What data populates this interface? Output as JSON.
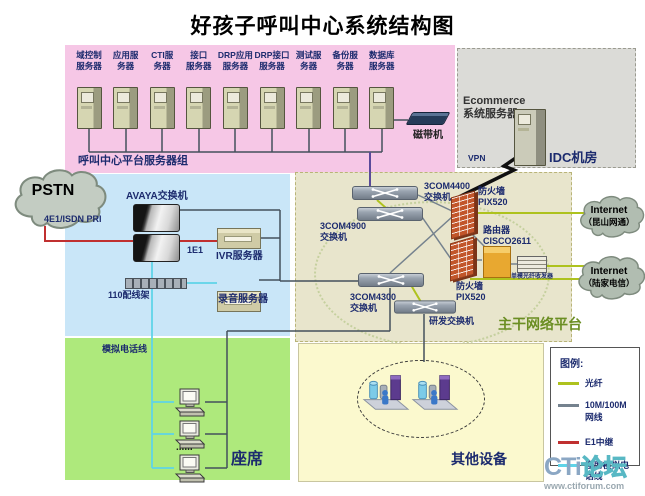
{
  "title": "好孩子呼叫中心系统结构图",
  "server_group": {
    "label": "呼叫中心平台服务器组",
    "servers": [
      {
        "line1": "域控制",
        "line2": "服务器"
      },
      {
        "line1": "应用服",
        "line2": "务器"
      },
      {
        "line1": "CTI服",
        "line2": "务器"
      },
      {
        "line1": "接口",
        "line2": "服务器"
      },
      {
        "line1": "DRP应用",
        "line2": "服务器"
      },
      {
        "line1": "DRP接口",
        "line2": "服务器"
      },
      {
        "line1": "测试服",
        "line2": "务器"
      },
      {
        "line1": "备份服",
        "line2": "务器"
      },
      {
        "line1": "数据库",
        "line2": "服务器"
      }
    ],
    "tape_drive": "磁带机"
  },
  "idc": {
    "ecommerce_line1": "Ecommerce",
    "ecommerce_line2": "系统服务器",
    "vpn": "VPN",
    "label": "IDC机房"
  },
  "telephony": {
    "pstn": "PSTN",
    "trunk": "4E1/ISDN PRI",
    "avaya": "AVAYA交换机",
    "e1": "1E1",
    "ivr": "IVR服务器",
    "frame110": "110配线架",
    "recorder": "录音服务器"
  },
  "backbone": {
    "sw4400_1": "3COM4400",
    "sw4400_2": "交换机",
    "sw4900_1": "3COM4900",
    "sw4900_2": "交换机",
    "sw4300_1": "3COM4300",
    "sw4300_2": "交换机",
    "fw1_1": "防火墙",
    "fw1_2": "PIX520",
    "fw2_1": "防火墙",
    "fw2_2": "PIX520",
    "router_1": "路由器",
    "router_2": "CISCO2611",
    "transceiver": "单模光纤收发器",
    "rd_switch": "研发交换机",
    "label": "主干网络平台"
  },
  "internet": {
    "cloud1_1": "Internet",
    "cloud1_2": "（昆山网通）",
    "cloud2_1": "Internet",
    "cloud2_2": "（陆家电信）"
  },
  "agents": {
    "phone_line": "模拟电话线",
    "dots": "......",
    "label": "座席"
  },
  "others": {
    "label": "其他设备"
  },
  "legend": {
    "title": "图例:",
    "items": [
      {
        "label": "光纤",
        "color": "#aec21e"
      },
      {
        "label": "10M/100M网线",
        "color": "#75828e"
      },
      {
        "label": "E1中继",
        "color": "#c03030"
      },
      {
        "label": "座席模拟电话线",
        "color": "#5fd4e8"
      }
    ]
  },
  "colors": {
    "fiber": "#aec21e",
    "lan": "#75828e",
    "e1": "#c03030",
    "agent_phone": "#5fd4e8"
  },
  "watermark": {
    "brand1": "CTi",
    "brand2": "论坛",
    "url": "www.ctiforum.com"
  }
}
